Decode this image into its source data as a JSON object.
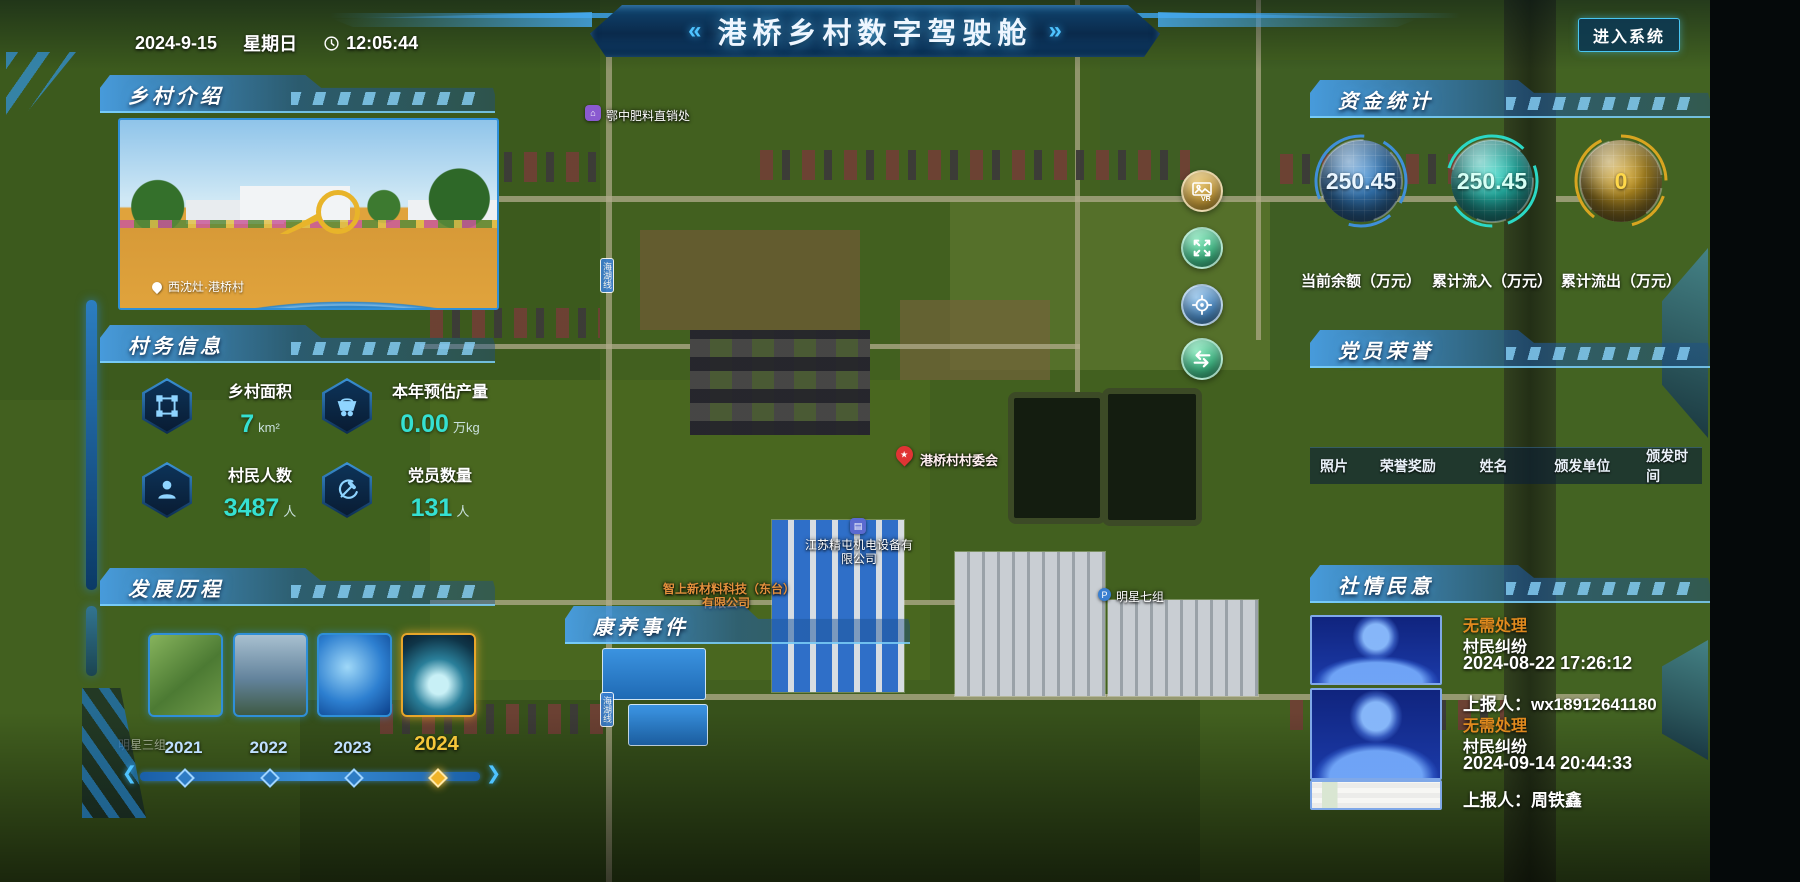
{
  "header": {
    "title": "港桥乡村数字驾驶舱",
    "left_chevron": "«",
    "right_chevron": "»",
    "date": "2024-9-15",
    "weekday": "星期日",
    "time": "12:05:44",
    "enter_button": "进入系统"
  },
  "panels": {
    "intro": {
      "title": "乡村介绍",
      "photo_caption": "西沈灶·港桥村"
    },
    "affairs": {
      "title": "村务信息",
      "stats": [
        {
          "label": "乡村面积",
          "value": "7",
          "unit": "km²"
        },
        {
          "label": "本年预估产量",
          "value": "0.00",
          "unit": "万kg"
        },
        {
          "label": "村民人数",
          "value": "3487",
          "unit": "人"
        },
        {
          "label": "党员数量",
          "value": "131",
          "unit": "人"
        }
      ]
    },
    "history": {
      "title": "发展历程",
      "years": [
        "2021",
        "2022",
        "2023",
        "2024"
      ],
      "active_year": "2024"
    },
    "funds": {
      "title": "资金统计",
      "gauges": [
        {
          "value": "250.45",
          "label": "当前余额（万元）",
          "color": "#3f8fd8",
          "value_color": "#eaf6ff"
        },
        {
          "value": "250.45",
          "label": "累计流入（万元）",
          "color": "#2bd8c5",
          "value_color": "#d6fff5"
        },
        {
          "value": "0",
          "label": "累计流出（万元）",
          "color": "#d8a520",
          "value_color": "#ffd84a"
        }
      ]
    },
    "honors": {
      "title": "党员荣誉",
      "columns": [
        "照片",
        "荣誉奖励",
        "姓名",
        "颁发单位",
        "颁发时间"
      ]
    },
    "sentiment": {
      "title": "社情民意",
      "items": [
        {
          "status": "无需处理",
          "type": "村民纠纷",
          "datetime": "2024-08-22 17:26:12",
          "reporter": "上报人：wx18912641180"
        },
        {
          "status": "无需处理",
          "type": "村民纠纷",
          "datetime": "2024-09-14 20:44:33",
          "reporter": "上报人：周铁鑫"
        }
      ]
    }
  },
  "map": {
    "event_header": "康养事件",
    "labels": [
      "鄂中肥料直销处",
      "港桥村村委会",
      "江苏精屯机电设备有限公司",
      "智上新材料科技（东台）有限公司",
      "明星七组",
      "明星三组",
      "海湖线"
    ]
  }
}
